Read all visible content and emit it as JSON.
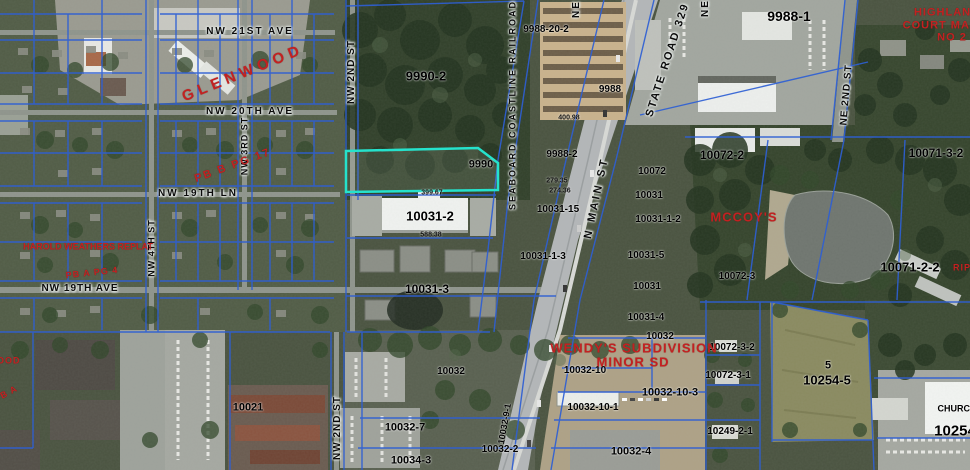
{
  "map": {
    "highlighted_parcel": {
      "id": "9990",
      "outline_color": "#25e2cc"
    },
    "colors": {
      "parcel_line": "#2e5fd4",
      "highlight_outline": "#25e2cc",
      "subdivision_text": "#c32121",
      "street_text": "#0b0b0b",
      "parcel_text": "#000000"
    },
    "labels": {
      "streets": [
        {
          "text": "NW 21ST AVE",
          "x": 250,
          "y": 32
        },
        {
          "text": "NW 20TH AVE",
          "x": 250,
          "y": 112
        },
        {
          "text": "NW 19TH LN",
          "x": 198,
          "y": 194
        },
        {
          "text": "NW 19TH AVE",
          "x": 80,
          "y": 289,
          "ls": 1
        },
        {
          "text": "NW 2ND ST",
          "x": 352,
          "y": 72,
          "rot": -90,
          "ls": 1
        },
        {
          "text": "NW 2ND ST",
          "x": 338,
          "y": 428,
          "rot": -90,
          "ls": 1
        },
        {
          "text": "NW 4TH ST",
          "x": 152,
          "y": 248,
          "rot": -90,
          "size": 9,
          "ls": 1
        },
        {
          "text": "NW 3RD ST",
          "x": 245,
          "y": 146,
          "rot": -90,
          "size": 9,
          "ls": 1
        },
        {
          "text": "N MAIN ST",
          "x": 597,
          "y": 198,
          "rot": -78,
          "size": 11,
          "ls": 3
        },
        {
          "text": "STATE ROAD 329",
          "x": 668,
          "y": 60,
          "rot": -72,
          "size": 11,
          "ls": 2
        },
        {
          "text": "SEABOARD COASTLINE RAILROAD",
          "x": 513,
          "y": 105,
          "rot": -90,
          "size": 9,
          "ls": 2
        },
        {
          "text": "NE 2ND ST",
          "x": 847,
          "y": 95,
          "rot": -85,
          "ls": 1
        },
        {
          "text": "NE",
          "x": 577,
          "y": 9,
          "rot": -90
        },
        {
          "text": "NE",
          "x": 706,
          "y": 8,
          "rot": -90
        }
      ],
      "parcels": [
        {
          "text": "9990-2",
          "x": 426,
          "y": 76,
          "size": 13
        },
        {
          "text": "9990",
          "x": 481,
          "y": 165,
          "size": 11
        },
        {
          "text": "9988-20-2",
          "x": 546,
          "y": 30,
          "size": 10
        },
        {
          "text": "9988-1",
          "x": 789,
          "y": 16,
          "size": 14
        },
        {
          "text": "9988",
          "x": 610,
          "y": 90,
          "size": 10
        },
        {
          "text": "9988-2",
          "x": 562,
          "y": 155,
          "size": 10
        },
        {
          "text": "10031-15",
          "x": 558,
          "y": 210,
          "size": 10
        },
        {
          "text": "10072",
          "x": 652,
          "y": 172,
          "size": 10
        },
        {
          "text": "10031",
          "x": 649,
          "y": 196,
          "size": 10
        },
        {
          "text": "10031-1-2",
          "x": 658,
          "y": 220,
          "size": 10
        },
        {
          "text": "10031-1-3",
          "x": 543,
          "y": 257,
          "size": 10
        },
        {
          "text": "10031-5",
          "x": 646,
          "y": 256,
          "size": 10
        },
        {
          "text": "10031",
          "x": 647,
          "y": 287,
          "size": 10
        },
        {
          "text": "10031-4",
          "x": 646,
          "y": 318,
          "size": 10
        },
        {
          "text": "10031-2",
          "x": 430,
          "y": 216,
          "size": 13
        },
        {
          "text": "10031-3",
          "x": 427,
          "y": 289,
          "size": 12
        },
        {
          "text": "10072-2",
          "x": 722,
          "y": 155,
          "size": 12
        },
        {
          "text": "10071-3-2",
          "x": 936,
          "y": 153,
          "size": 12
        },
        {
          "text": "10071-2-2",
          "x": 910,
          "y": 267,
          "size": 13
        },
        {
          "text": "10072-3",
          "x": 737,
          "y": 277,
          "size": 10
        },
        {
          "text": "10072-3-2",
          "x": 732,
          "y": 348,
          "size": 10
        },
        {
          "text": "10072-3-1",
          "x": 728,
          "y": 376,
          "size": 10
        },
        {
          "text": "10249-2-1",
          "x": 730,
          "y": 432,
          "size": 10
        },
        {
          "text": "5",
          "x": 828,
          "y": 366,
          "size": 11
        },
        {
          "text": "10254-5",
          "x": 827,
          "y": 380,
          "size": 13
        },
        {
          "text": "10254",
          "x": 955,
          "y": 431,
          "size": 15
        },
        {
          "text": "CHURCH",
          "x": 957,
          "y": 409,
          "size": 9
        },
        {
          "text": "10032",
          "x": 660,
          "y": 337,
          "size": 10
        },
        {
          "text": "10032",
          "x": 451,
          "y": 372,
          "size": 10
        },
        {
          "text": "10032-10",
          "x": 585,
          "y": 371,
          "size": 10
        },
        {
          "text": "10032-10-3",
          "x": 670,
          "y": 393,
          "size": 11
        },
        {
          "text": "10032-10-1",
          "x": 593,
          "y": 408,
          "size": 10
        },
        {
          "text": "10032-4",
          "x": 631,
          "y": 452,
          "size": 11
        },
        {
          "text": "10021",
          "x": 248,
          "y": 408,
          "size": 11
        },
        {
          "text": "10032-7",
          "x": 405,
          "y": 428,
          "size": 11
        },
        {
          "text": "10034-3",
          "x": 411,
          "y": 461,
          "size": 11
        },
        {
          "text": "10032-2",
          "x": 500,
          "y": 450,
          "size": 10
        },
        {
          "text": "10032-9-1",
          "x": 505,
          "y": 424,
          "size": 9,
          "rot": -80
        }
      ],
      "subdivisions": [
        {
          "text": "GLENWOOD",
          "x": 243,
          "y": 73,
          "rot": -22,
          "size": 15,
          "ls": 5
        },
        {
          "text": "PB B PG 17",
          "x": 233,
          "y": 166,
          "rot": -20,
          "size": 11,
          "ls": 2
        },
        {
          "text": "HAROLD WEATHERS REPLAT",
          "x": 88,
          "y": 247,
          "size": 9,
          "ls": 0
        },
        {
          "text": "PB A PG 4",
          "x": 92,
          "y": 273,
          "rot": -6,
          "size": 9
        },
        {
          "text": "MCCOY'S",
          "x": 744,
          "y": 217,
          "size": 13,
          "ls": 1
        },
        {
          "text": "WENDY'S SUBDIVISION",
          "x": 634,
          "y": 348,
          "size": 13,
          "ls": 1
        },
        {
          "text": "MINOR SD",
          "x": 633,
          "y": 362,
          "size": 13,
          "ls": 1
        },
        {
          "text": "HIGHLAND",
          "x": 947,
          "y": 13,
          "size": 11
        },
        {
          "text": "COURT MANOR",
          "x": 950,
          "y": 26,
          "size": 11
        },
        {
          "text": "NO 2",
          "x": 952,
          "y": 38,
          "size": 11
        },
        {
          "text": "RIP",
          "x": 962,
          "y": 268,
          "size": 9
        },
        {
          "text": "WOOD",
          "x": 4,
          "y": 361,
          "size": 9
        },
        {
          "text": "PB A",
          "x": 6,
          "y": 394,
          "rot": -28,
          "size": 9
        }
      ],
      "dimensions": [
        {
          "text": "399.67",
          "x": 432,
          "y": 193
        },
        {
          "text": "588.38",
          "x": 431,
          "y": 235
        },
        {
          "text": "400.98",
          "x": 569,
          "y": 118
        },
        {
          "text": "279.35",
          "x": 557,
          "y": 181
        },
        {
          "text": "274.36",
          "x": 560,
          "y": 191
        }
      ]
    }
  }
}
